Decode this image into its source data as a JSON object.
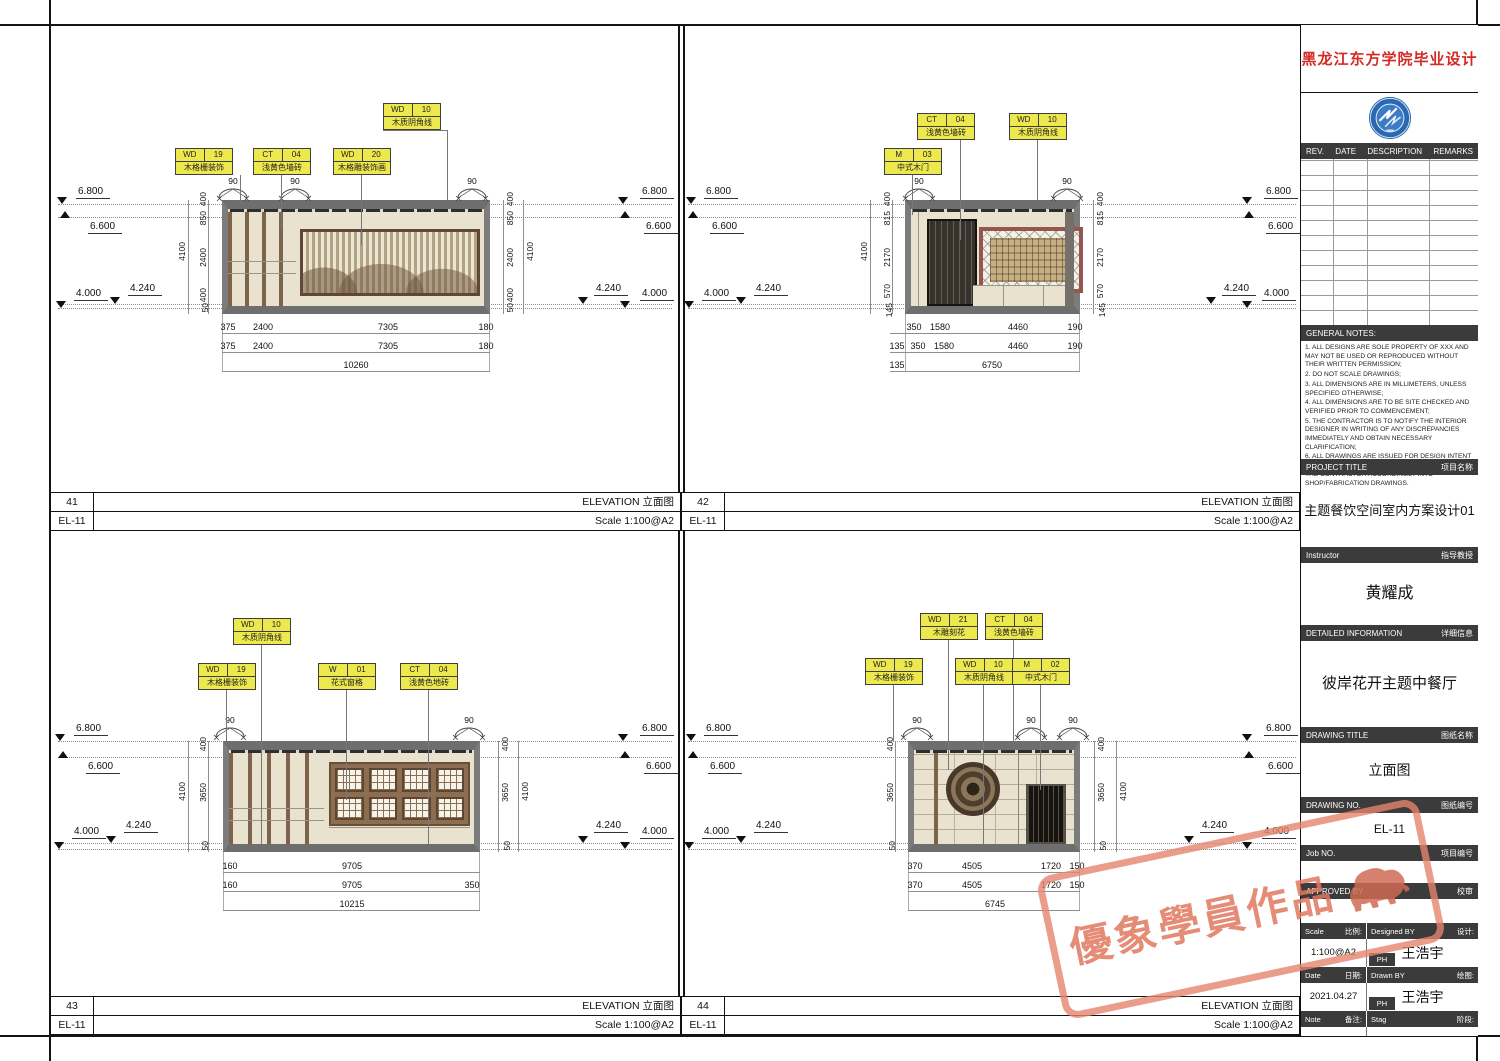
{
  "levels": {
    "l1": "6.800",
    "l2": "6.600",
    "l3": "4.240",
    "l4": "4.000"
  },
  "downlight_angle": "90",
  "views": [
    {
      "number": "41",
      "sheet_no": "EL-11",
      "title": "ELEVATION 立面图",
      "scale": "Scale 1:100@A2",
      "tags": [
        {
          "code": "WD",
          "num": "10",
          "desc": "木质阴角线"
        },
        {
          "code": "WD",
          "num": "19",
          "desc": "木格栅装饰"
        },
        {
          "code": "CT",
          "num": "04",
          "desc": "浅黄色墙砖"
        },
        {
          "code": "WD",
          "num": "20",
          "desc": "木格雕装饰画"
        }
      ],
      "vdims": [
        "400",
        "850",
        "2400",
        "400",
        "50"
      ],
      "vtotal": "4100",
      "hrow1": [
        "375",
        "2400",
        "7305",
        "180"
      ],
      "hrow2": [
        "375",
        "2400",
        "7305",
        "180"
      ],
      "htotal": "10260"
    },
    {
      "number": "42",
      "sheet_no": "EL-11",
      "title": "ELEVATION 立面图",
      "scale": "Scale 1:100@A2",
      "tags": [
        {
          "code": "CT",
          "num": "04",
          "desc": "浅黄色墙砖"
        },
        {
          "code": "WD",
          "num": "10",
          "desc": "木质阴角线"
        },
        {
          "code": "M",
          "num": "03",
          "desc": "中式木门"
        }
      ],
      "vdims": [
        "400",
        "815",
        "2170",
        "570",
        "145"
      ],
      "vtotal": "4100",
      "hrow1": [
        "350",
        "1580",
        "4460",
        "190"
      ],
      "hrow2": [
        "135",
        "350",
        "1580",
        "4460",
        "190"
      ],
      "hrow3": [
        "135",
        "6750"
      ]
    },
    {
      "number": "43",
      "sheet_no": "EL-11",
      "title": "ELEVATION 立面图",
      "scale": "Scale 1:100@A2",
      "tags": [
        {
          "code": "WD",
          "num": "10",
          "desc": "木质阴角线"
        },
        {
          "code": "WD",
          "num": "19",
          "desc": "木格栅装饰"
        },
        {
          "code": "W",
          "num": "01",
          "desc": "花式窗格"
        },
        {
          "code": "CT",
          "num": "04",
          "desc": "浅黄色地砖"
        }
      ],
      "vdims": [
        "400",
        "3650",
        "50"
      ],
      "vtotal": "4100",
      "hrow1": [
        "160",
        "9705"
      ],
      "hrow2": [
        "160",
        "9705",
        "350"
      ],
      "htotal": "10215"
    },
    {
      "number": "44",
      "sheet_no": "EL-11",
      "title": "ELEVATION 立面图",
      "scale": "Scale 1:100@A2",
      "tags": [
        {
          "code": "WD",
          "num": "21",
          "desc": "木雕刻花"
        },
        {
          "code": "CT",
          "num": "04",
          "desc": "浅黄色墙砖"
        },
        {
          "code": "WD",
          "num": "19",
          "desc": "木格栅装饰"
        },
        {
          "code": "WD",
          "num": "10",
          "desc": "木质阴角线"
        },
        {
          "code": "M",
          "num": "02",
          "desc": "中式木门"
        }
      ],
      "vdims": [
        "400",
        "3650",
        "50"
      ],
      "vtotal": "4100",
      "hrow1": [
        "370",
        "4505",
        "1720",
        "150"
      ],
      "hrow2": [
        "370",
        "4505",
        "1720",
        "150"
      ],
      "htotal": "6745"
    }
  ],
  "titleblock": {
    "school_title": "黑龙江东方学院毕业设计",
    "logo": "university-emblem",
    "rev_headers": [
      "REV.",
      "DATE",
      "DESCRIPTION",
      "REMARKS"
    ],
    "general_notes": {
      "label": "GENERAL NOTES:",
      "lines": [
        "1. ALL DESIGNS ARE SOLE PROPERTY OF XXX AND MAY NOT BE USED OR REPRODUCED WITHOUT THEIR WRITTEN PERMISSION;",
        "2. DO NOT SCALE DRAWINGS;",
        "3. ALL DIMENSIONS ARE IN MILLIMETERS, UNLESS SPECIFIED OTHERWISE;",
        "4. ALL DIMENSIONS ARE TO BE SITE CHECKED AND VERIFIED PRIOR TO COMMENCEMENT;",
        "5. THE CONTRACTOR IS TO NOTIFY THE INTERIOR DESIGNER IN WRITING OF ANY DISCREPANCIES IMMEDIATELY AND OBTAIN NECESSARY CLARIFICATION;",
        "6. ALL DRAWINGS ARE ISSUED FOR DESIGN INTENT AND WHERE REQUIRED ARE TO BE DEVELOPED BY THE CONTRACTOR ACCORDINGLY INTO SHOP/FABRICATION DRAWINGS."
      ]
    },
    "project_title": {
      "en": "PROJECT TITLE",
      "zh": "项目名称",
      "value": "主题餐饮空间室内方案设计01"
    },
    "instructor": {
      "en": "Instructor",
      "zh": "指导教授",
      "value": "黄耀成"
    },
    "detailed_information": {
      "en": "DETAILED INFORMATION",
      "zh": "详细信息",
      "value": "彼岸花开主题中餐厅"
    },
    "drawing_title": {
      "en": "DRAWING TITLE",
      "zh": "图纸名称",
      "value": "立面图"
    },
    "drawing_no": {
      "en": "DRAWING NO.",
      "zh": "图纸编号",
      "value": "EL-11"
    },
    "job_no": {
      "en": "Job NO.",
      "zh": "项目编号",
      "value": ""
    },
    "approved_by": {
      "en": "APPROVED BY",
      "zh": "校审",
      "value": ""
    },
    "scale": {
      "en": "Scale",
      "zh": "比例:",
      "value": "1:100@A2"
    },
    "designed_by": {
      "en": "Designed BY",
      "zh": "设计:",
      "badge": "PH",
      "value": "王浩宇"
    },
    "date": {
      "en": "Date",
      "zh": "日期:",
      "value": "2021.04.27"
    },
    "drawn_by": {
      "en": "Drawn BY",
      "zh": "绘图:",
      "badge": "PH",
      "value": "王浩宇"
    },
    "note": {
      "en": "Note",
      "zh": "备注:",
      "value": ""
    },
    "stage": {
      "en": "Stag",
      "zh": "阶段:",
      "value": ""
    }
  },
  "watermark": {
    "text": "優象學員作品",
    "color": "#e08572"
  }
}
